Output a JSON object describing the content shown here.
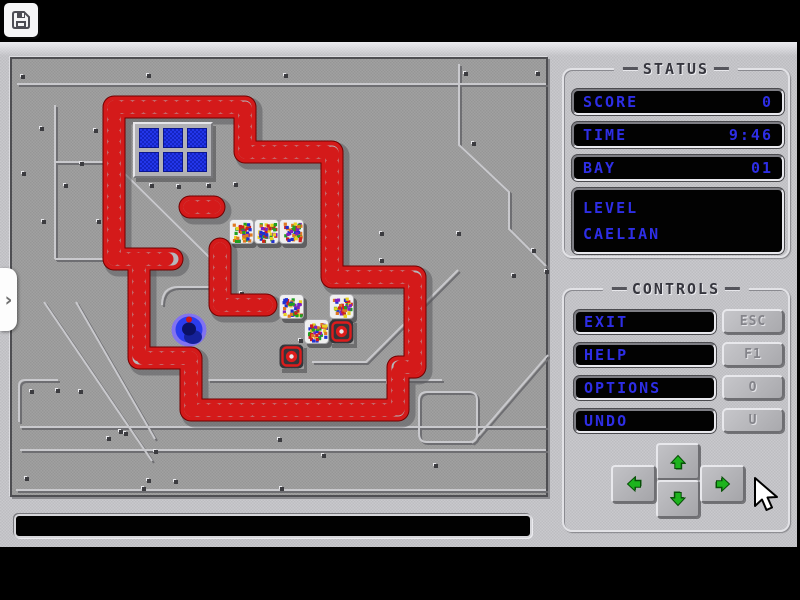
{
  "toolbar": {
    "save_icon": "floppy-disk"
  },
  "side_tab": {
    "chevron": "›"
  },
  "status_panel": {
    "title": "STATUS",
    "fields": [
      {
        "label": "SCORE",
        "value": "0"
      },
      {
        "label": "TIME",
        "value": "9:46"
      },
      {
        "label": "BAY",
        "value": "01"
      }
    ],
    "level_label": "LEVEL",
    "level_value": "CAELIAN"
  },
  "controls_panel": {
    "title": "CONTROLS",
    "buttons": [
      {
        "label": "EXIT",
        "key": "ESC"
      },
      {
        "label": "HELP",
        "key": "F1"
      },
      {
        "label": "OPTIONS",
        "key": "O"
      },
      {
        "label": "UNDO",
        "key": "U"
      }
    ],
    "arrows": [
      "up",
      "left",
      "down",
      "right"
    ]
  },
  "message_bar": {
    "text": ""
  },
  "colors": {
    "lcd_text": "#2e2ee6",
    "pipe_red": "#d41a1a",
    "pipe_dark_red": "#700000",
    "pipe_gray": "#b6b6ba",
    "arrow_green": "#1db41d",
    "player_blue": "#2b3cee",
    "window_blue": "#2336ea",
    "confetti": [
      "#d02020",
      "#2030d0",
      "#e8d020",
      "#20a020",
      "#8020c0",
      "#e07820"
    ]
  },
  "board": {
    "walls": [
      "M102,48 H233 V93 H320 V218 H403 V308 H386 V351 H179 V299 H127 V200 H102 Z",
      "M129,200 H160",
      "M208,190 V246 H254",
      "M178,148 H202"
    ],
    "window": {
      "x": 121,
      "y": 63,
      "w": 80,
      "h": 56,
      "cols": 3,
      "rows": 2
    },
    "crates": [
      [
        217,
        160
      ],
      [
        242,
        160
      ],
      [
        267,
        160
      ],
      [
        267,
        235
      ],
      [
        317,
        235
      ],
      [
        292,
        260
      ]
    ],
    "targets": [
      [
        317,
        260
      ],
      [
        267,
        285
      ]
    ],
    "player": {
      "x": 158,
      "y": 253
    },
    "decor": [
      "M5,25 H534",
      "M43,46 V200",
      "M43,103 H101 L198,199",
      "M43,200 H126",
      "M447,5 V86 L497,133 V170 L534,207",
      "M300,303 H354 L446,211",
      "M460,384 L536,296",
      "M196,321 H430",
      "M8,368 H534",
      "M8,391 H534",
      "M4,431 H534",
      "M32,243 L140,402",
      "M64,243 L143,380",
      "M7,363 V327 Q7,321 13,321 H46",
      "M150,246 Q150,228 166,228 H206",
      "M415,333 H457 Q465,333 465,341 V375 Q465,383 457,383 H415 Q407,383 407,375 V341 Q407,333 415,333"
    ],
    "rivets": [
      [
        9,
        16
      ],
      [
        135,
        15
      ],
      [
        272,
        15
      ],
      [
        452,
        13
      ],
      [
        524,
        13
      ],
      [
        28,
        68
      ],
      [
        82,
        70
      ],
      [
        68,
        103
      ],
      [
        10,
        113
      ],
      [
        52,
        125
      ],
      [
        138,
        125
      ],
      [
        165,
        126
      ],
      [
        195,
        125
      ],
      [
        222,
        124
      ],
      [
        30,
        161
      ],
      [
        85,
        161
      ],
      [
        460,
        83
      ],
      [
        368,
        173
      ],
      [
        445,
        173
      ],
      [
        520,
        190
      ],
      [
        368,
        200
      ],
      [
        500,
        215
      ],
      [
        228,
        233
      ],
      [
        287,
        280
      ],
      [
        375,
        323
      ],
      [
        18,
        331
      ],
      [
        44,
        330
      ],
      [
        67,
        331
      ],
      [
        95,
        378
      ],
      [
        107,
        371
      ],
      [
        13,
        418
      ],
      [
        135,
        420
      ],
      [
        112,
        373
      ],
      [
        142,
        391
      ],
      [
        130,
        428
      ],
      [
        162,
        421
      ],
      [
        266,
        379
      ],
      [
        268,
        428
      ],
      [
        310,
        395
      ],
      [
        422,
        405
      ],
      [
        533,
        211
      ]
    ]
  }
}
